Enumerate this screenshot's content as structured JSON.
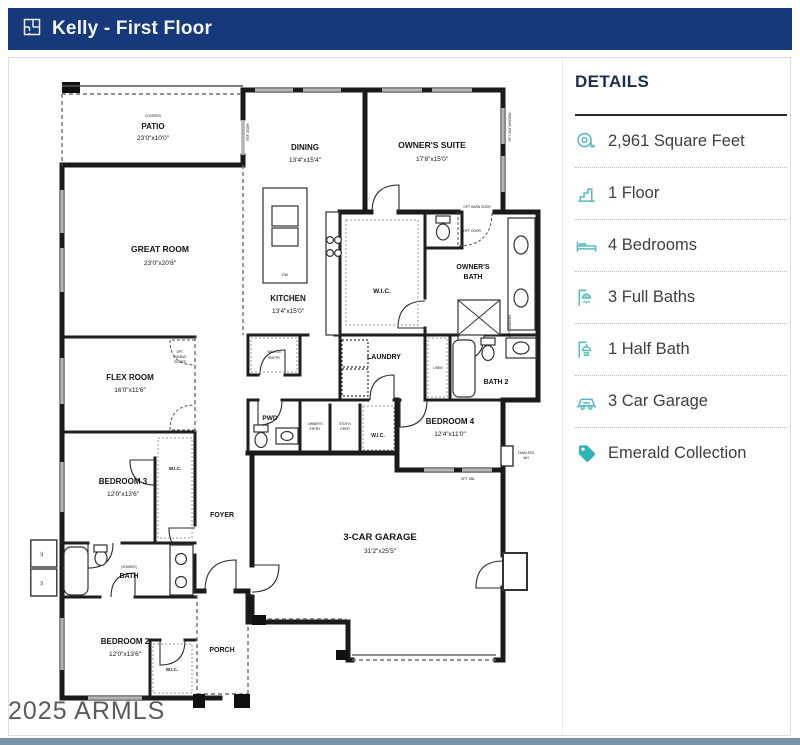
{
  "header": {
    "title": "Kelly - First Floor"
  },
  "watermark": "2025 ARMLS",
  "details": {
    "title": "DETAILS",
    "items": [
      {
        "icon": "tape-measure-icon",
        "label": "2,961 Square Feet"
      },
      {
        "icon": "stairs-icon",
        "label": "1 Floor"
      },
      {
        "icon": "bed-icon",
        "label": "4 Bedrooms"
      },
      {
        "icon": "bathtub-icon",
        "label": "3 Full Baths"
      },
      {
        "icon": "shower-icon",
        "label": "1 Half Bath"
      },
      {
        "icon": "car-icon",
        "label": "3 Car Garage"
      },
      {
        "icon": "tag-icon",
        "label": "Emerald Collection"
      }
    ],
    "accent_color": "#57bcc2",
    "tag_color": "#2fb3b9"
  },
  "plan": {
    "rooms": {
      "patio": {
        "tag": "COVERED",
        "name": "PATIO",
        "dims": "23'0\"x10'0\""
      },
      "dining": {
        "name": "DINING",
        "dims": "13'4\"x15'4\""
      },
      "owners_suite": {
        "name": "OWNER'S SUITE",
        "dims": "17'8\"x15'0\""
      },
      "great_room": {
        "name": "GREAT ROOM",
        "dims": "23'0\"x20'8\""
      },
      "kitchen": {
        "name": "KITCHEN",
        "dims": "13'4\"x15'0\""
      },
      "wic_owner": {
        "name": "W.I.C."
      },
      "owners_bath_1": "OWNER'S",
      "owners_bath_2": "BATH",
      "flex": {
        "name": "FLEX ROOM",
        "dims": "16'0\"x11'6\""
      },
      "laundry": {
        "name": "LAUNDRY"
      },
      "bath2": {
        "name": "BATH 2"
      },
      "bedroom4": {
        "name": "BEDROOM 4",
        "dims": "12'4\"x11'0\""
      },
      "pwd": {
        "name": "PWD"
      },
      "wic_bed4": {
        "name": "W.I.C."
      },
      "bedroom3": {
        "name": "BEDROOM 3",
        "dims": "12'0\"x13'6\""
      },
      "wic_bed3": {
        "name": "W.I.C."
      },
      "foyer": {
        "name": "FOYER"
      },
      "bath_shared": {
        "tag": "(SHARED)",
        "name": "BATH"
      },
      "bedroom2": {
        "name": "BEDROOM 2",
        "dims": "12'0\"x13'6\""
      },
      "wic_bed2": {
        "name": "W.I.C."
      },
      "porch": {
        "name": "PORCH"
      },
      "garage": {
        "name": "3-CAR GARAGE",
        "dims": "31'2\"x25'5\""
      }
    },
    "annotations": {
      "ref_door": "REF. DOOR",
      "opt_barn_door": "OPT. BARN DOOR",
      "opt_door": "OPT. DOOR",
      "opt_double_1": "OPT.",
      "opt_double_2": "DOUBLE",
      "opt_double_3": "DOORS",
      "pantry_1": "WALK-IN",
      "pantry_2": "PANTRY",
      "owners_entry_1": "OWNER'S",
      "owners_entry_2": "ENTRY",
      "stop_1": "STOP N",
      "stop_2": "DROP",
      "linen": "LINEN",
      "opt_dbl": "OPT. DBL",
      "tankless_1": "TANKLESS",
      "tankless_2": "WH",
      "opt_bay_window": "OPT. BAY WINDOW",
      "opt_window": "OPT. WINDOW",
      "dw": "DW",
      "ac": "AC"
    }
  }
}
